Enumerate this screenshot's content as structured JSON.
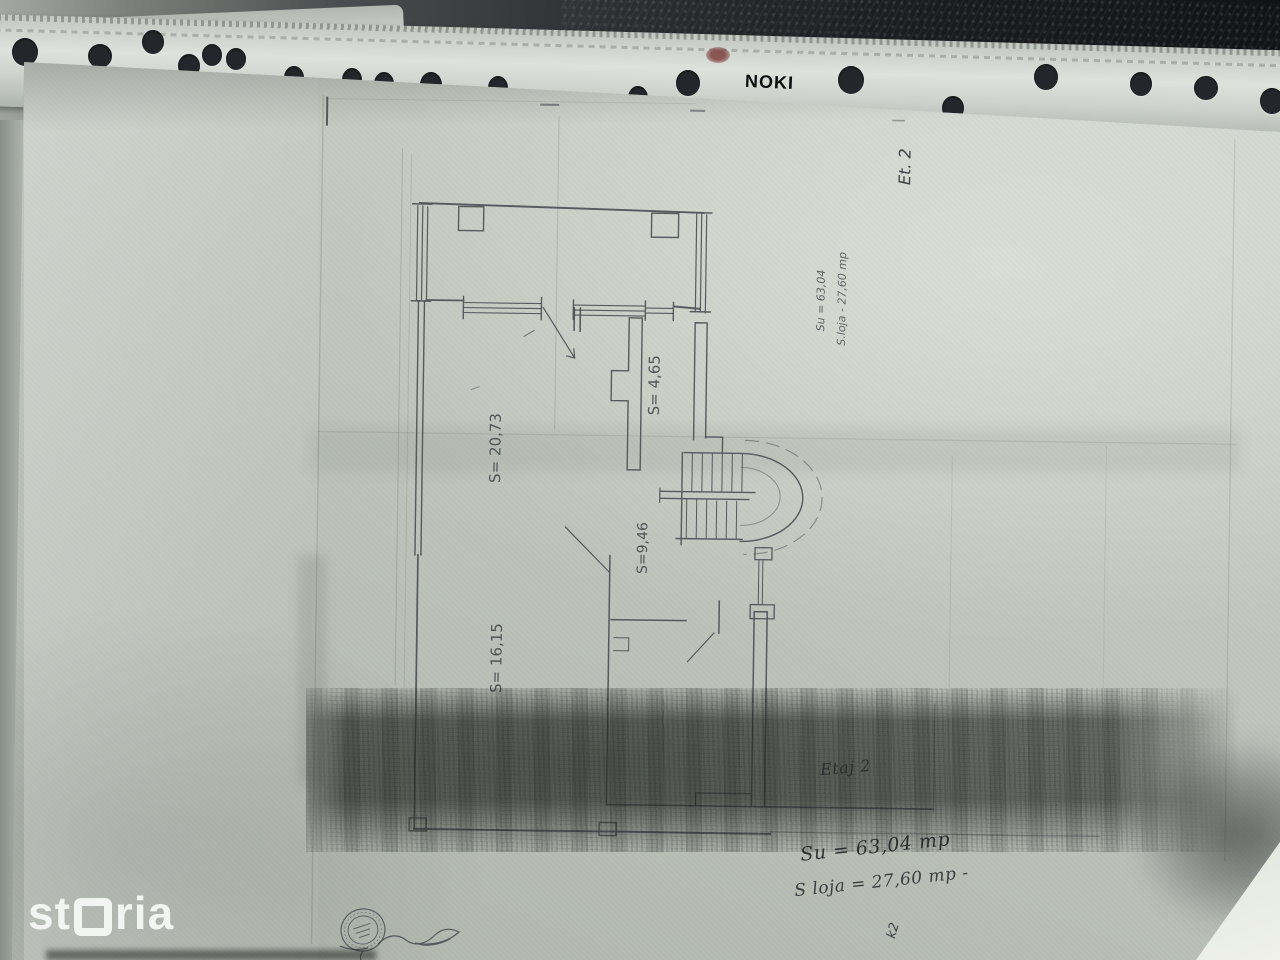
{
  "sleeve": {
    "brand": "NOKI"
  },
  "watermark": {
    "prefix": "st",
    "suffix": "ria"
  },
  "floorplan": {
    "room_labels": [
      "S= 20,73",
      "S= 4,65",
      "S=9,46",
      "S= 16,15"
    ],
    "floor_mark": "Et. 2",
    "pencil_notes": [
      "Su = 63,04",
      "S.loja - 27,60 mp"
    ],
    "corner_mark": "k2"
  },
  "annotations": {
    "floor_line": "Etaj 2",
    "usable_area_line": "Su = 63,04 mp",
    "loggia_area_line": "S loja = 27,60 mp -"
  }
}
